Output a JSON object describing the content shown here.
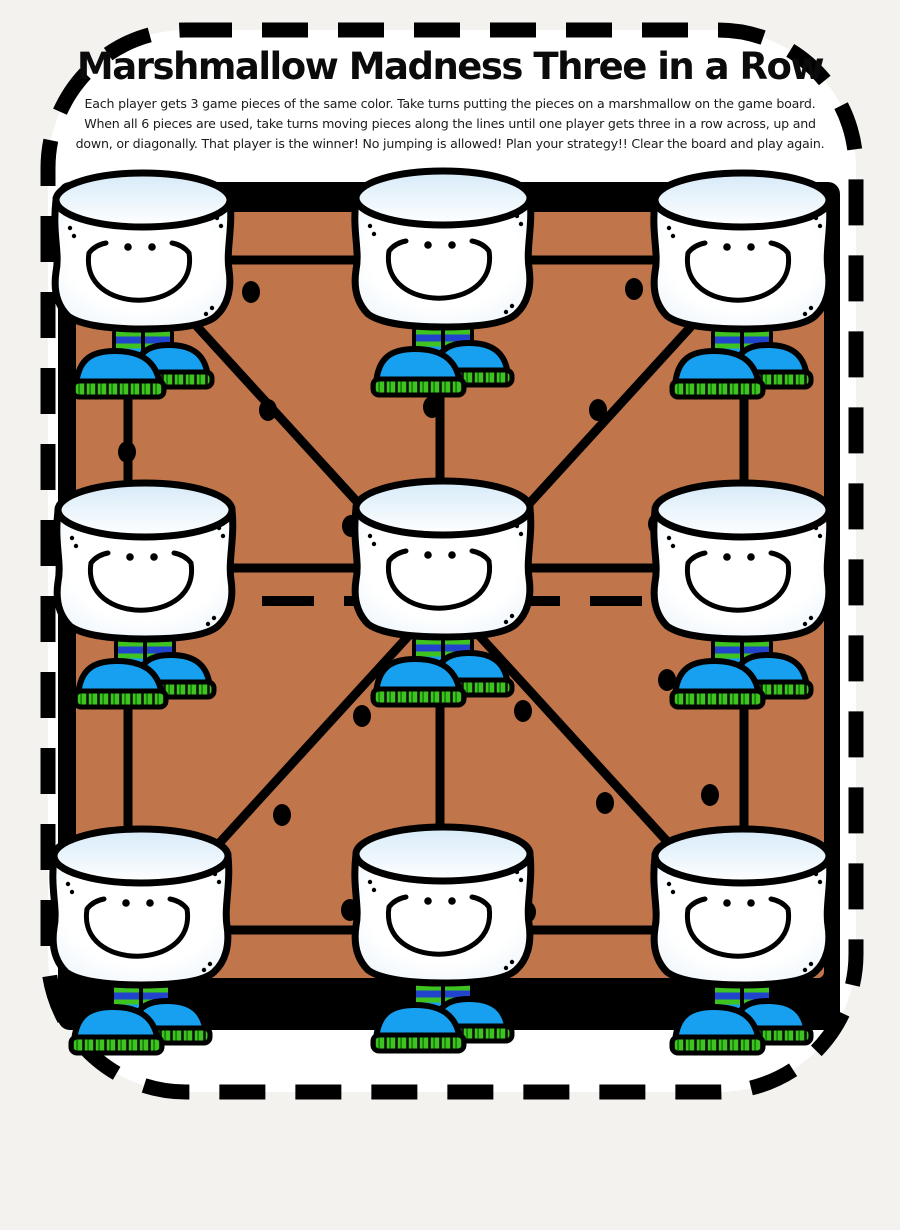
{
  "title": "Marshmallow Madness Three in a Row",
  "instructions": {
    "line1": "Each player gets 3 game pieces of the same color. Take turns putting the pieces on a marshmallow on the game board.",
    "line2": "When all 6 pieces are used, take turns moving pieces along the lines until one player gets three in a row across, up and",
    "line3": "down, or diagonally. That player is the winner! No jumping is allowed!  Plan your strategy!!  Clear the board and play again."
  },
  "colors": {
    "page_bg": "#f3f2ef",
    "paper": "#ffffff",
    "ink": "#000000",
    "board_fill": "#c0764a",
    "shoe": "#18a0f0",
    "green": "#3ec321",
    "sock_blue": "#2244cc",
    "lid_tint": "#d6eaf8",
    "body_tint": "#e6f1fa"
  },
  "page": {
    "border": {
      "x": 48,
      "y": 30,
      "width": 808,
      "height": 1062,
      "radius": 138
    }
  },
  "board": {
    "frame": {
      "x": 58,
      "y": 182,
      "width": 782,
      "height": 848
    },
    "inner": {
      "x": 76,
      "y": 212,
      "width": 748,
      "height": 766
    },
    "lines": [
      {
        "x1": 105,
        "y1": 260,
        "x2": 780,
        "y2": 260,
        "dashed": false
      },
      {
        "x1": 92,
        "y1": 568,
        "x2": 818,
        "y2": 568,
        "dashed": false
      },
      {
        "x1": 105,
        "y1": 930,
        "x2": 780,
        "y2": 930,
        "dashed": false
      },
      {
        "x1": 128,
        "y1": 258,
        "x2": 128,
        "y2": 932,
        "dashed": false
      },
      {
        "x1": 440,
        "y1": 258,
        "x2": 440,
        "y2": 932,
        "dashed": false
      },
      {
        "x1": 744,
        "y1": 258,
        "x2": 744,
        "y2": 932,
        "dashed": false
      },
      {
        "x1": 140,
        "y1": 264,
        "x2": 748,
        "y2": 930,
        "dashed": false
      },
      {
        "x1": 748,
        "y1": 264,
        "x2": 140,
        "y2": 930,
        "dashed": false
      },
      {
        "x1": 98,
        "y1": 601,
        "x2": 815,
        "y2": 601,
        "dashed": true
      }
    ],
    "dots": [
      {
        "x": 251,
        "y": 292
      },
      {
        "x": 634,
        "y": 289
      },
      {
        "x": 268,
        "y": 410
      },
      {
        "x": 432,
        "y": 407
      },
      {
        "x": 598,
        "y": 410
      },
      {
        "x": 127,
        "y": 452
      },
      {
        "x": 351,
        "y": 526
      },
      {
        "x": 657,
        "y": 524
      },
      {
        "x": 667,
        "y": 680
      },
      {
        "x": 362,
        "y": 716
      },
      {
        "x": 523,
        "y": 711
      },
      {
        "x": 282,
        "y": 815
      },
      {
        "x": 605,
        "y": 803
      },
      {
        "x": 710,
        "y": 795
      },
      {
        "x": 350,
        "y": 910
      },
      {
        "x": 527,
        "y": 912
      }
    ],
    "nodes": [
      {
        "id": "top-left",
        "cx": 143,
        "top": 172
      },
      {
        "id": "top-center",
        "cx": 443,
        "top": 170
      },
      {
        "id": "top-right",
        "cx": 742,
        "top": 172
      },
      {
        "id": "middle-left",
        "cx": 145,
        "top": 482
      },
      {
        "id": "middle-center",
        "cx": 443,
        "top": 480
      },
      {
        "id": "middle-right",
        "cx": 742,
        "top": 482
      },
      {
        "id": "bottom-left",
        "cx": 141,
        "top": 828
      },
      {
        "id": "bottom-center",
        "cx": 443,
        "top": 826
      },
      {
        "id": "bottom-right",
        "cx": 742,
        "top": 828
      }
    ]
  },
  "marshmallow": {
    "character": "smiling marshmallow with blue sneakers",
    "count": 9
  }
}
